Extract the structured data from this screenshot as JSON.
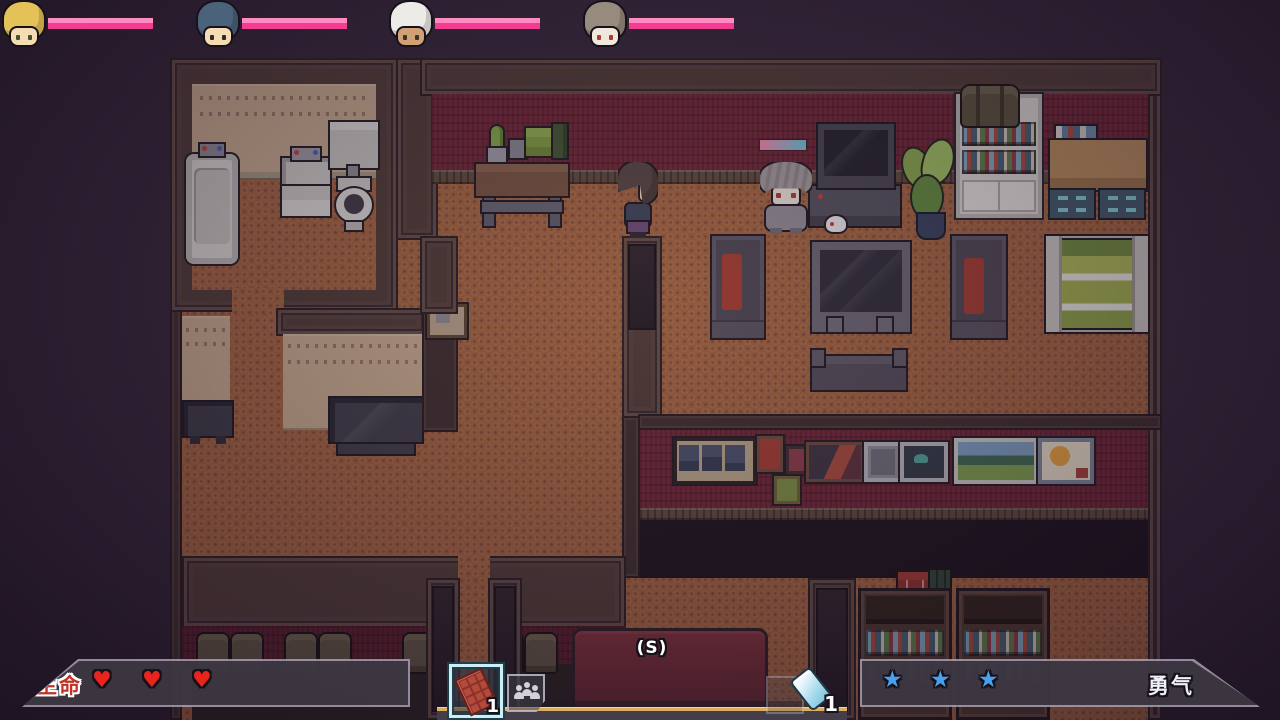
{
  "hud": {
    "party": [
      {
        "role": "party-member-1",
        "hair": "#e5c257",
        "skin": "#f5dcb2",
        "eyes": "#44512f",
        "hp_pct": 100
      },
      {
        "role": "party-member-2",
        "hair": "#4b627b",
        "skin": "#f5dcb2",
        "eyes": "#2a2a33",
        "hp_pct": 100
      },
      {
        "role": "party-member-3",
        "hair": "#edebe7",
        "skin": "#d2a173",
        "eyes": "#3a332e",
        "hp_pct": 100
      },
      {
        "role": "party-member-4",
        "hair": "#978b7d",
        "skin": "#efe8dc",
        "eyes": "#b23a2c",
        "hp_pct": 100
      }
    ],
    "hp_bar_color": "#f43c93",
    "life": {
      "label": "生命",
      "count": 3,
      "glyph": "♥",
      "color": "#e8241c"
    },
    "courage": {
      "label": "勇气",
      "count": 3,
      "glyph": "★",
      "color": "#4aa0ee"
    },
    "inventory": {
      "slots": [
        {
          "icon": "chocolate-bar-icon",
          "count": "1",
          "selected": true
        },
        {
          "icon": "contacts-icon",
          "count": "",
          "selected": false
        }
      ],
      "phone": {
        "icon": "phone-icon",
        "count": "1"
      }
    },
    "interact_hint": "(S)"
  },
  "npc": {
    "health_bar_gradient": [
      "#f288ab",
      "#67c6d8"
    ]
  }
}
